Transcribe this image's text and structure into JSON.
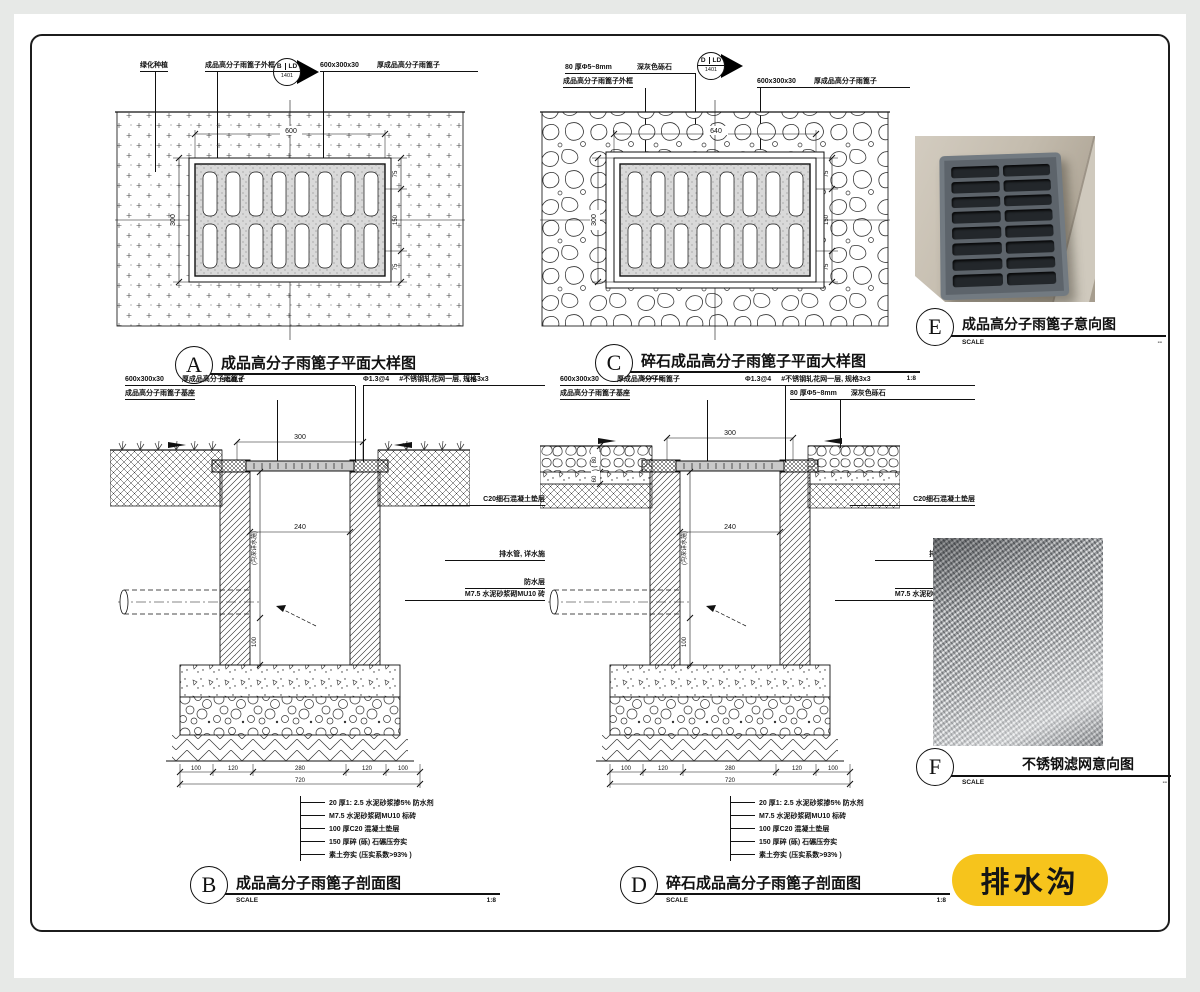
{
  "badge": {
    "label": "排水沟"
  },
  "flags": {
    "a": {
      "l": "B",
      "r": "LD",
      "n": "1401"
    },
    "c": {
      "l": "D",
      "r": "LD",
      "n": "1401"
    }
  },
  "planA": {
    "ref": "A",
    "title": "成品高分子雨篦子平面大样图",
    "scale_label": "SCALE",
    "scale": "1:8",
    "lbl_area": "绿化种植",
    "lbl_frame": "成品高分子雨篦子外框",
    "lbl_size": "600x300x30",
    "lbl_grate": "厚成品高分子雨篦子",
    "dim_top": "600",
    "dim_left": "300",
    "dim_r1": "75",
    "dim_r2": "150",
    "dim_r3": "75"
  },
  "planC": {
    "ref": "C",
    "title": "碎石成品高分子雨篦子平面大样图",
    "scale_label": "SCALE",
    "scale": "1:8",
    "lbl_gravel1": "80 厚Φ5~8mm",
    "lbl_gravel2": "深灰色砾石",
    "lbl_frame": "成品高分子雨篦子外框",
    "lbl_size": "600x300x30",
    "lbl_grate": "厚成品高分子雨篦子",
    "dim_top": "640",
    "dim_left": "300",
    "dim_r1": "75",
    "dim_r2": "150",
    "dim_r3": "75"
  },
  "secB": {
    "ref": "B",
    "title": "成品高分子雨篦子剖面图",
    "scale_label": "SCALE",
    "scale": "1:8",
    "lbl_size": "600x300x30",
    "lbl_grate": "厚成品高分子雨篦子",
    "lbl_base": "成品高分子雨篦子基座",
    "lbl_mesh1": "Φ1.3@4",
    "lbl_mesh2": "#不锈钢轧花网一层, 规格3x3",
    "r1": "C20细石混凝土垫层",
    "r2": "排水管, 详水施",
    "r3": "防水层",
    "r4": "M7.5 水泥砂浆砌MU10 砖",
    "dim_open": "300",
    "dim_inner": "240",
    "dim_depth": "(沟深详水施)",
    "dim_100": "100",
    "chain": [
      "100",
      "120",
      "280",
      "120",
      "100"
    ],
    "total": "720"
  },
  "secD": {
    "ref": "D",
    "title": "碎石成品高分子雨篦子剖面图",
    "scale_label": "SCALE",
    "scale": "1:8",
    "lbl_size": "600x300x30",
    "lbl_grate": "厚成品高分子雨篦子",
    "lbl_base": "成品高分子雨篦子基座",
    "lbl_mesh1": "Φ1.3@4",
    "lbl_mesh2": "#不锈钢轧花网一层, 规格3x3",
    "lbl_g1": "80 厚Φ5~8mm",
    "lbl_g2": "深灰色砾石",
    "r1": "C20细石混凝土垫层",
    "r2": "排水管, 详水施",
    "r3": "防水层",
    "r4": "M7.5 水泥砂浆砌MU10 砖",
    "dim_open": "300",
    "dim_inner": "240",
    "dim_depth": "(沟深详水施)",
    "dim_100": "100",
    "dim_80": "80",
    "dim_60": "60",
    "chain": [
      "100",
      "120",
      "280",
      "120",
      "100"
    ],
    "total": "720"
  },
  "notes": [
    "20 厚1: 2.5  水泥砂浆掺5% 防水剂",
    "M7.5  水泥砂浆砌MU10  标砖",
    "100  厚C20  混凝土垫层",
    "150  厚碎 (砾) 石碾压夯实",
    "素土夯实 (压实系数>93% )"
  ],
  "viewE": {
    "ref": "E",
    "title": "成品高分子雨篦子意向图",
    "scale_label": "SCALE",
    "scale": "--"
  },
  "viewF": {
    "ref": "F",
    "title": "不锈钢滤网意向图",
    "scale_label": "SCALE",
    "scale": "--"
  }
}
